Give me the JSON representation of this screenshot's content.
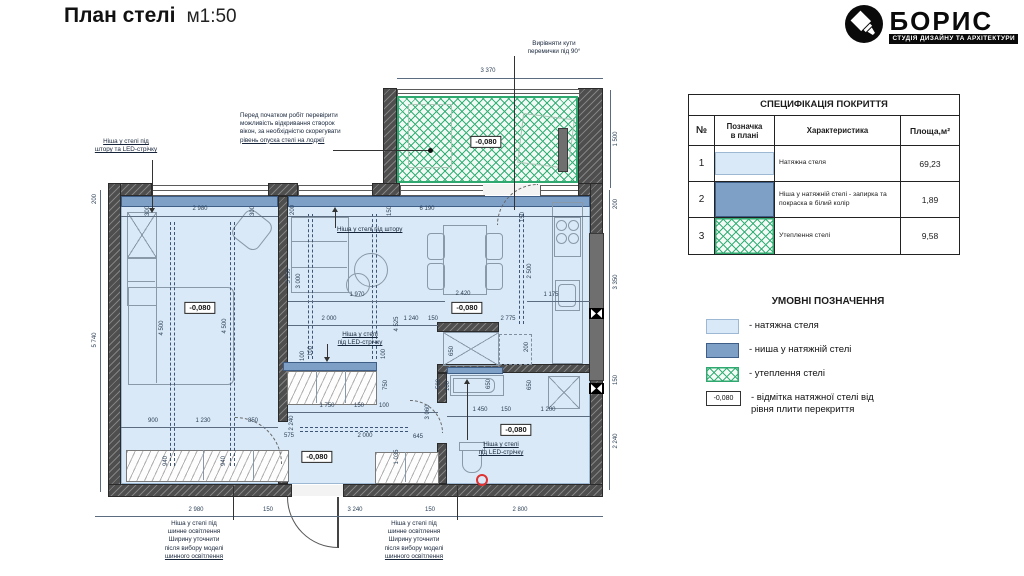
{
  "header": {
    "title": "План стелі",
    "scale": "м1:50"
  },
  "logo": {
    "name": "БОРИС",
    "tagline": "СТУДІЯ ДИЗАЙНУ ТА АРХІТЕКТУРИ"
  },
  "colors": {
    "ceiling_fill": "#d9e9f7",
    "niche_fill": "#7e9fc6",
    "insulation_green": "#2fa96f",
    "wall_gray": "#4e4e4e",
    "marker_red": "#e03131"
  },
  "spec_table": {
    "title": "СПЕЦИФІКАЦІЯ ПОКРИТТЯ",
    "headers": [
      "№",
      "Позначка\nв плані",
      "Характеристика",
      "Площа,м²"
    ],
    "rows": [
      {
        "num": "1",
        "swatch": "ceiling",
        "text": "Натяжна стеля",
        "area": "69,23"
      },
      {
        "num": "2",
        "swatch": "niche",
        "text": "Ніша у натяжній стелі  - запирка та покраска в білий колір",
        "area": "1,89"
      },
      {
        "num": "3",
        "swatch": "insulation",
        "text": "Утеплення стелі",
        "area": "9,58"
      }
    ]
  },
  "legend": {
    "title": "УМОВНІ ПОЗНАЧЕННЯ",
    "items": [
      {
        "swatch": "ceiling",
        "label": "- натяжна стеля"
      },
      {
        "swatch": "niche",
        "label": "- ниша у натяжній стелі"
      },
      {
        "swatch": "insulation",
        "label": "- утеплення стелі"
      },
      {
        "swatch": "elevation",
        "swatch_text": "-0,080",
        "label": "- відмітка натяжної стелі від\nрівня плити перекриття"
      }
    ]
  },
  "plan": {
    "elevation_label": "-0,080",
    "elevations": [
      [
        200,
        308
      ],
      [
        467,
        308
      ],
      [
        486,
        142
      ],
      [
        317,
        457
      ],
      [
        516,
        430
      ]
    ],
    "dims": [
      [
        "3 370",
        488,
        71,
        0
      ],
      [
        "1 500",
        616,
        139,
        1
      ],
      [
        "200",
        95,
        199,
        1
      ],
      [
        "5 740",
        95,
        340,
        1
      ],
      [
        "200",
        616,
        204,
        1
      ],
      [
        "3 350",
        616,
        282,
        1
      ],
      [
        "150",
        616,
        380,
        1
      ],
      [
        "2 240",
        616,
        441,
        1
      ],
      [
        "2 980",
        196,
        510,
        0
      ],
      [
        "150",
        268,
        510,
        0
      ],
      [
        "3 240",
        355,
        510,
        0
      ],
      [
        "150",
        430,
        510,
        0
      ],
      [
        "2 800",
        520,
        510,
        0
      ],
      [
        "2 980",
        200,
        209,
        0
      ],
      [
        "300",
        148,
        211,
        1
      ],
      [
        "300",
        253,
        211,
        1
      ],
      [
        "4 500",
        162,
        328,
        1
      ],
      [
        "4 500",
        225,
        326,
        1
      ],
      [
        "900",
        153,
        421,
        0
      ],
      [
        "1 230",
        203,
        421,
        0
      ],
      [
        "850",
        253,
        421,
        0
      ],
      [
        "940",
        166,
        461,
        1
      ],
      [
        "940",
        224,
        461,
        1
      ],
      [
        "200",
        293,
        210,
        1
      ],
      [
        "150",
        390,
        211,
        1
      ],
      [
        "6 190",
        427,
        209,
        0
      ],
      [
        "3 250",
        289,
        276,
        1
      ],
      [
        "3 000",
        299,
        281,
        1
      ],
      [
        "1 970",
        357,
        295,
        0
      ],
      [
        "2 420",
        463,
        294,
        0
      ],
      [
        "2 000",
        329,
        319,
        0
      ],
      [
        "1 240",
        411,
        319,
        0
      ],
      [
        "150",
        433,
        319,
        0
      ],
      [
        "2 775",
        508,
        319,
        0
      ],
      [
        "4 525",
        397,
        324,
        1
      ],
      [
        "100",
        311,
        351,
        1
      ],
      [
        "150",
        523,
        217,
        1
      ],
      [
        "2 500",
        530,
        271,
        1
      ],
      [
        "1 175",
        551,
        295,
        0
      ],
      [
        "650",
        452,
        351,
        1
      ],
      [
        "200",
        527,
        347,
        1
      ],
      [
        "100",
        303,
        356,
        1
      ],
      [
        "100",
        384,
        354,
        1
      ],
      [
        "750",
        386,
        385,
        1
      ],
      [
        "1 750",
        327,
        406,
        0
      ],
      [
        "150",
        359,
        406,
        0
      ],
      [
        "100",
        384,
        406,
        0
      ],
      [
        "2 240",
        292,
        423,
        1
      ],
      [
        "575",
        289,
        436,
        0
      ],
      [
        "2 000",
        365,
        436,
        0
      ],
      [
        "645",
        418,
        437,
        0
      ],
      [
        "1 035",
        397,
        457,
        1
      ],
      [
        "3 060",
        428,
        412,
        1
      ],
      [
        "500",
        439,
        384,
        1
      ],
      [
        "100",
        448,
        386,
        1
      ],
      [
        "650",
        489,
        384,
        1
      ],
      [
        "650",
        530,
        385,
        1
      ],
      [
        "1 450",
        480,
        410,
        0
      ],
      [
        "150",
        506,
        410,
        0
      ],
      [
        "1 200",
        548,
        410,
        0
      ]
    ],
    "annotations": [
      {
        "id": "window-note",
        "x": 240,
        "y": 112,
        "w": 140,
        "align": "left",
        "ul": "last",
        "lines": [
          "Перед початком робіт  перевірити",
          "можливість відкривання створок",
          "вікон, за необхідністю скорегувати",
          "рівень опуска стелі на лоджії"
        ]
      },
      {
        "id": "corner-note",
        "x": 514,
        "y": 40,
        "w": 80,
        "align": "center",
        "ul": "none",
        "lines": [
          "Вирівняти кути",
          "перемички під 90°"
        ]
      },
      {
        "id": "niche-curtain-led",
        "x": 84,
        "y": 138,
        "w": 84,
        "align": "center",
        "ul": "all",
        "lines": [
          "Ніша у стелі під",
          "штору та LED-стрічку"
        ]
      },
      {
        "id": "niche-curtain",
        "x": 337,
        "y": 226,
        "w": 90,
        "align": "left",
        "ul": "all",
        "lines": [
          "Ніша у стелі під штору"
        ]
      },
      {
        "id": "niche-led-mid",
        "x": 330,
        "y": 331,
        "w": 60,
        "align": "center",
        "ul": "all",
        "lines": [
          "Ніша у стелі",
          "під LED-стрічку"
        ]
      },
      {
        "id": "niche-led-bath",
        "x": 470,
        "y": 441,
        "w": 62,
        "align": "center",
        "ul": "all",
        "lines": [
          "Ніша у стелі",
          "під LED-стрічку"
        ]
      },
      {
        "id": "track-light-left",
        "x": 150,
        "y": 520,
        "w": 88,
        "align": "center",
        "ul": "last",
        "lines": [
          "Ніша у стелі під",
          "шинне освітлення",
          "Ширину уточнити",
          "після вибору моделі",
          "шинного освітлення"
        ]
      },
      {
        "id": "track-light-right",
        "x": 370,
        "y": 520,
        "w": 88,
        "align": "center",
        "ul": "last",
        "lines": [
          "Ніша у стелі під",
          "шинне освітлення",
          "Ширину уточнити",
          "після вибору моделі",
          "шинного освітлення"
        ]
      }
    ]
  }
}
